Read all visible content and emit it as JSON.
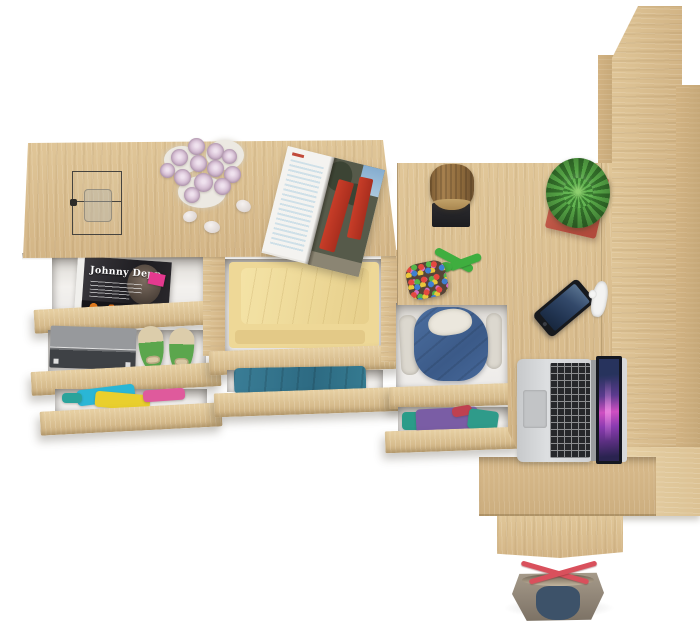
{
  "scene": {
    "type": "product-render",
    "description": "Top-down view of a light oak furniture set: a dresser with open drawers full of clothes, a corner desk with a laptop, a tall shelving unit and a tote bag",
    "background": "#ffffff"
  },
  "palette": {
    "wood": "#d8bc8e",
    "wood_dark": "#c8ab7c",
    "wood_light": "#e4cda2",
    "drawer_interior": "#f1efec",
    "shadow": "#d9d5cf"
  },
  "dresser": {
    "label": "oak dresser with open drawers",
    "top_items": {
      "glass_display_box": "wire-frame glass display box with tumbler",
      "rose_bouquet": "bouquet of pale pink roses",
      "rose_color": "#d9c3d7",
      "pebbles": "three white pebbles",
      "open_magazine": "open magazine with red city photos",
      "magazine_accent": "#c83d28"
    },
    "drawers": {
      "magazine": {
        "title": "Johnny Depp",
        "badge_color": "#e5398f",
        "cover": "#1d1c20"
      },
      "shoe_drawer": {
        "box_color": "#3e4145",
        "shoes": "green ballet flats with bows",
        "shoe_color": "#5ba64d"
      },
      "mixed_clothes": {
        "colors": [
          "#2ab6d6",
          "#e9cf2d",
          "#df5a9c",
          "#2aa39b"
        ]
      },
      "yellow_blanket": {
        "color": "#eed897"
      },
      "blue_clothes": {
        "color": "#357b91"
      }
    }
  },
  "desk": {
    "label": "oak corner desk",
    "items": {
      "wood_stump": {
        "label": "decorative wood stump on black stand",
        "color": "#96713f"
      },
      "bead_pouch": {
        "label": "multicolour bead pouch with green cord",
        "cord_color": "#3fae3f"
      },
      "succulent": {
        "label": "succulent in red square pot",
        "plant": "#55a445",
        "pot": "#b14a3c"
      },
      "smartphone": {
        "label": "smartphone face up",
        "screen": "#33496a"
      },
      "earphones": {
        "label": "white earphones",
        "color": "#f3f3f2"
      },
      "laptop": {
        "label": "open silver laptop",
        "body": "#d4d6d8",
        "keys": "#26282b",
        "screen": "#cf4fc2"
      }
    },
    "drawers": {
      "hoodie": {
        "label": "denim blue hoodie with fleece lining",
        "color": "#46689a"
      },
      "purple_teal": {
        "colors": [
          "#7a5da5",
          "#2a9c89",
          "#bf4150"
        ]
      }
    }
  },
  "shelf": {
    "label": "tall oak shelving unit seen from above"
  },
  "base": {
    "label": "oak base panel"
  },
  "tote_bag": {
    "label": "canvas tote bag with red straps",
    "body": "#8f8476",
    "panel": "#3d5269",
    "straps": "#d9505c"
  }
}
